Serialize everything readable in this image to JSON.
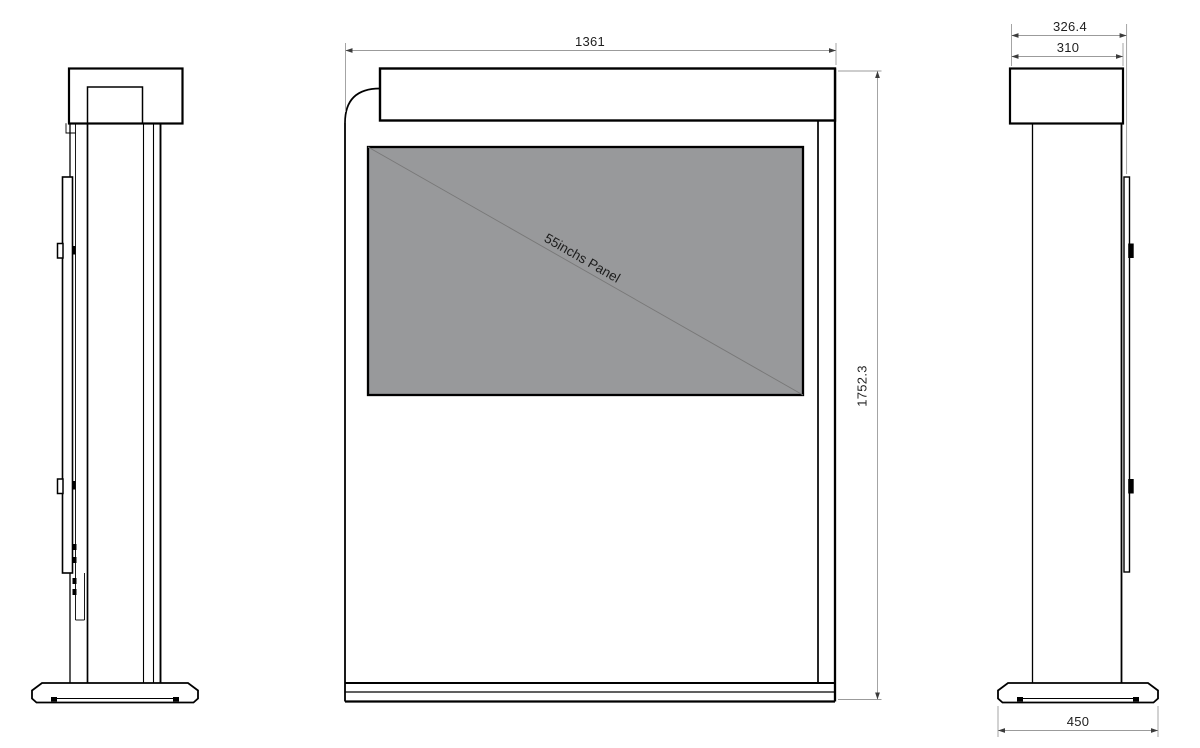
{
  "front_view": {
    "width_label": "1361",
    "height_label": "1752.3",
    "panel_label": "55inchs Panel"
  },
  "right_view": {
    "overall_depth_label": "326.4",
    "cabinet_depth_label": "310",
    "base_depth_label": "450"
  },
  "colors": {
    "background": "#ffffff",
    "outline": "#000000",
    "panel_fill": "#98999b",
    "panel_diagonal": "#787878",
    "dim_line": "#9b9b9b",
    "arrow": "#3c3c3c",
    "dim_text": "#1f1f1f"
  }
}
